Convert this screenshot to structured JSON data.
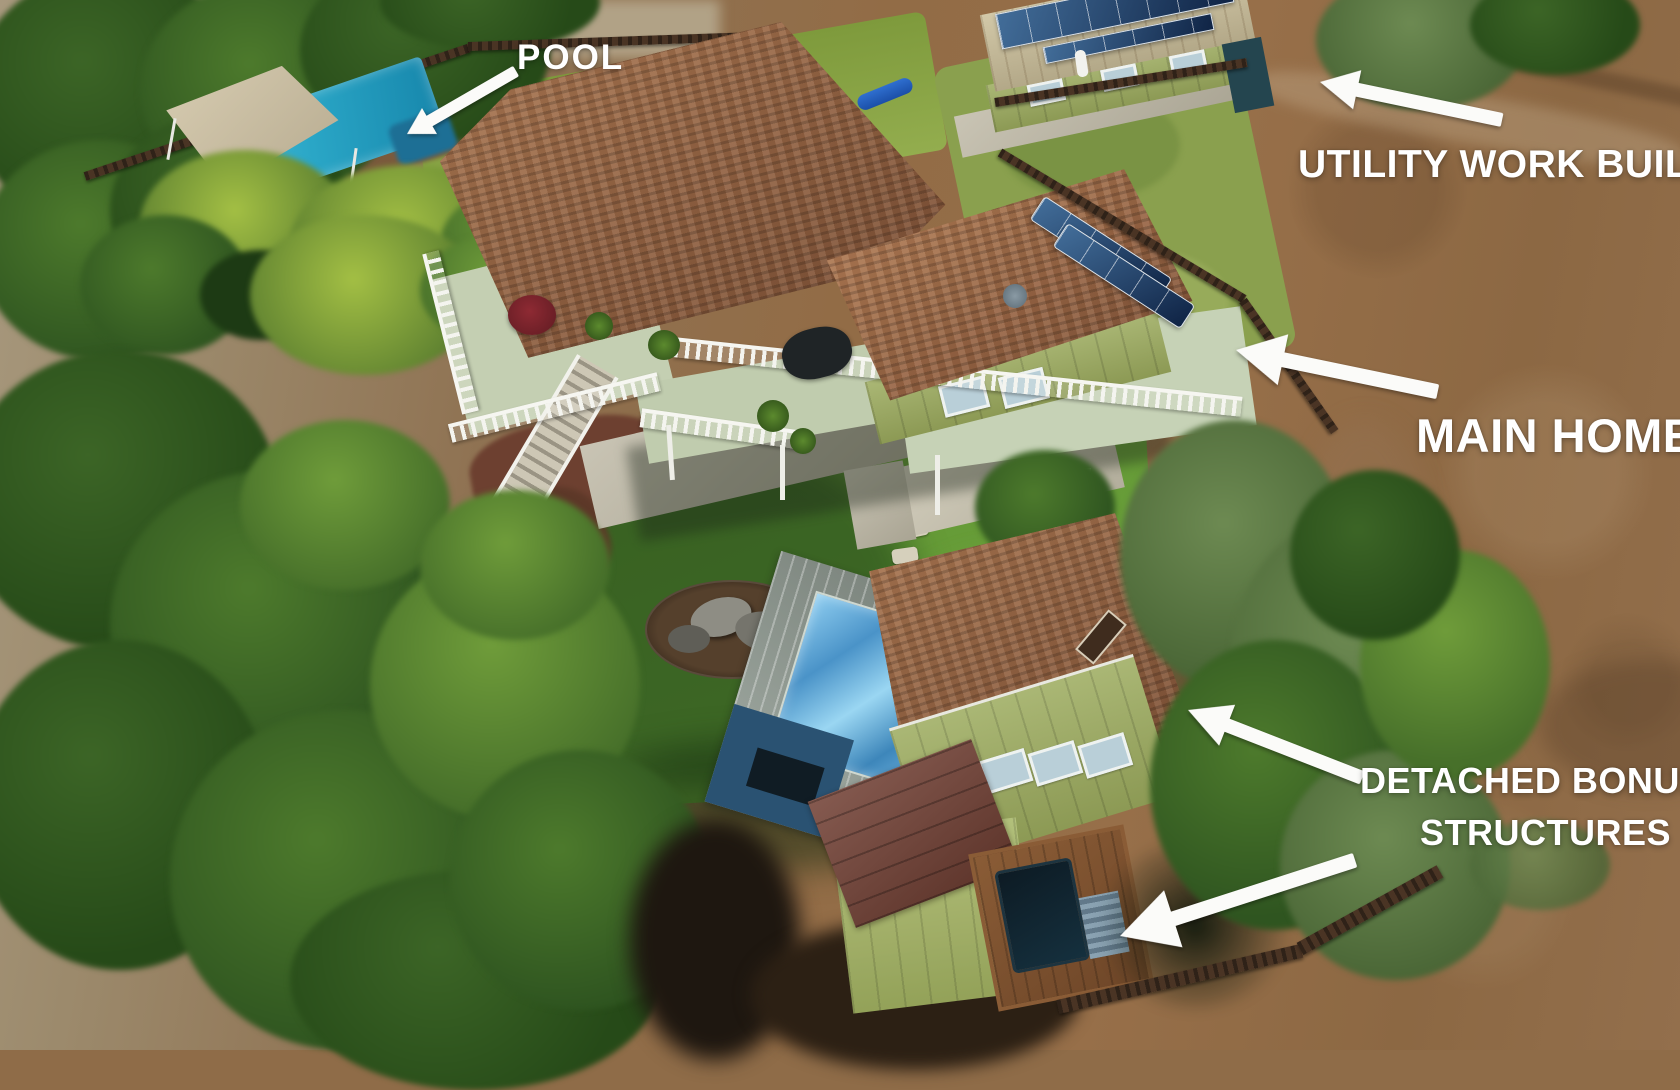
{
  "annotations": {
    "pool": {
      "label": "POOL"
    },
    "utility_building": {
      "label": "UTILITY WORK BUILDING"
    },
    "main_home": {
      "label": "MAIN HOME"
    },
    "detached_bonus": {
      "line1": "DETACHED BONUS",
      "line2": "STRUCTURES"
    }
  },
  "colors": {
    "annotation_text": "#ffffff",
    "arrow": "#fbfbf9",
    "roof_shingle": "#8f5f41",
    "house_siding": "#9cab5e",
    "pool_water": "#2aa6c6",
    "lap_pool_water": "#4a93c8",
    "solar_panel": "#16335a",
    "metal_roof": "#95a097",
    "maroon_roof": "#713f33",
    "lawn_green": "#5f9332",
    "dirt_brown": "#926c46",
    "shade_sail_tan": "#c9bda4"
  }
}
